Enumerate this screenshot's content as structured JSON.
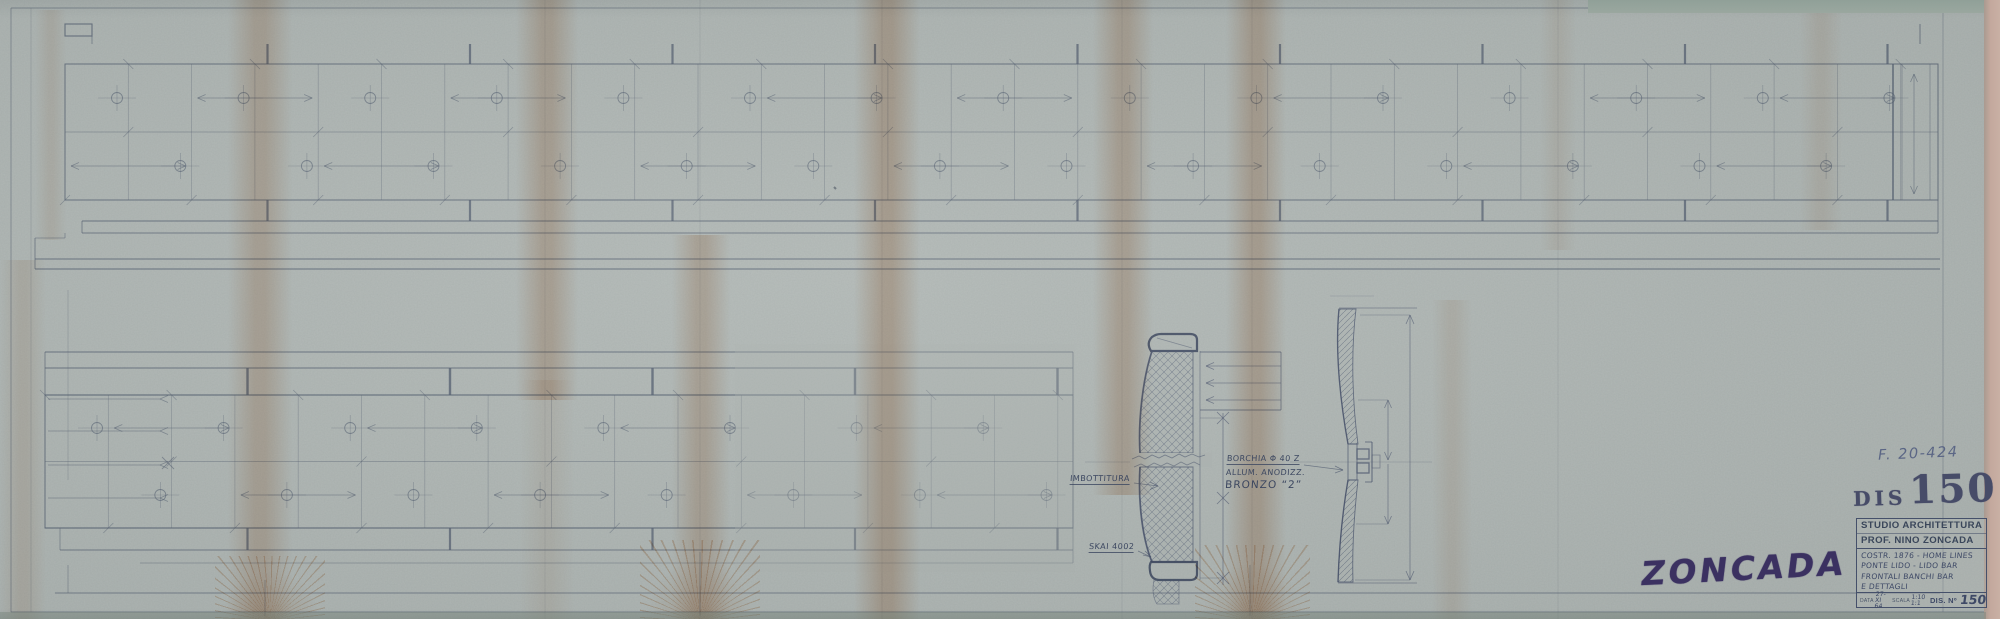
{
  "sheet": {
    "reference_code": "F. 20-424",
    "stamps": {
      "dis_prefix": "DIS",
      "dis_number": "150",
      "signature": "ZONCADA"
    },
    "annotations": {
      "padding": "IMBOTTITURA",
      "upholstery": "SKAI 4002",
      "stud_line1": "BORCHIA Φ 40 Z",
      "stud_line2": "ALLUM. ANODIZZ.",
      "stud_line3": "BRONZO “2”"
    },
    "title_block": {
      "studio": "STUDIO ARCHITETTURA",
      "architect": "PROF. NINO ZONCADA",
      "project": [
        "COSTR. 1876 - HOME LINES",
        "PONTE LIDO - LIDO BAR",
        "FRONTALI BANCHI BAR",
        "E DETTAGLI"
      ],
      "date_label": "DATA",
      "date_top": "27-XI",
      "date_bottom": "64",
      "scale_label": "SCALA",
      "scale_top": "1:10",
      "scale_bottom": "1:1",
      "number_label": "DIS. Nº",
      "number_value": "150"
    },
    "colors": {
      "paper": "#adb4b1",
      "pencil": "#556071",
      "pencil_dark": "#3a445c",
      "stamp_ink": "#3b3161",
      "stain": "#c98a5c"
    }
  }
}
